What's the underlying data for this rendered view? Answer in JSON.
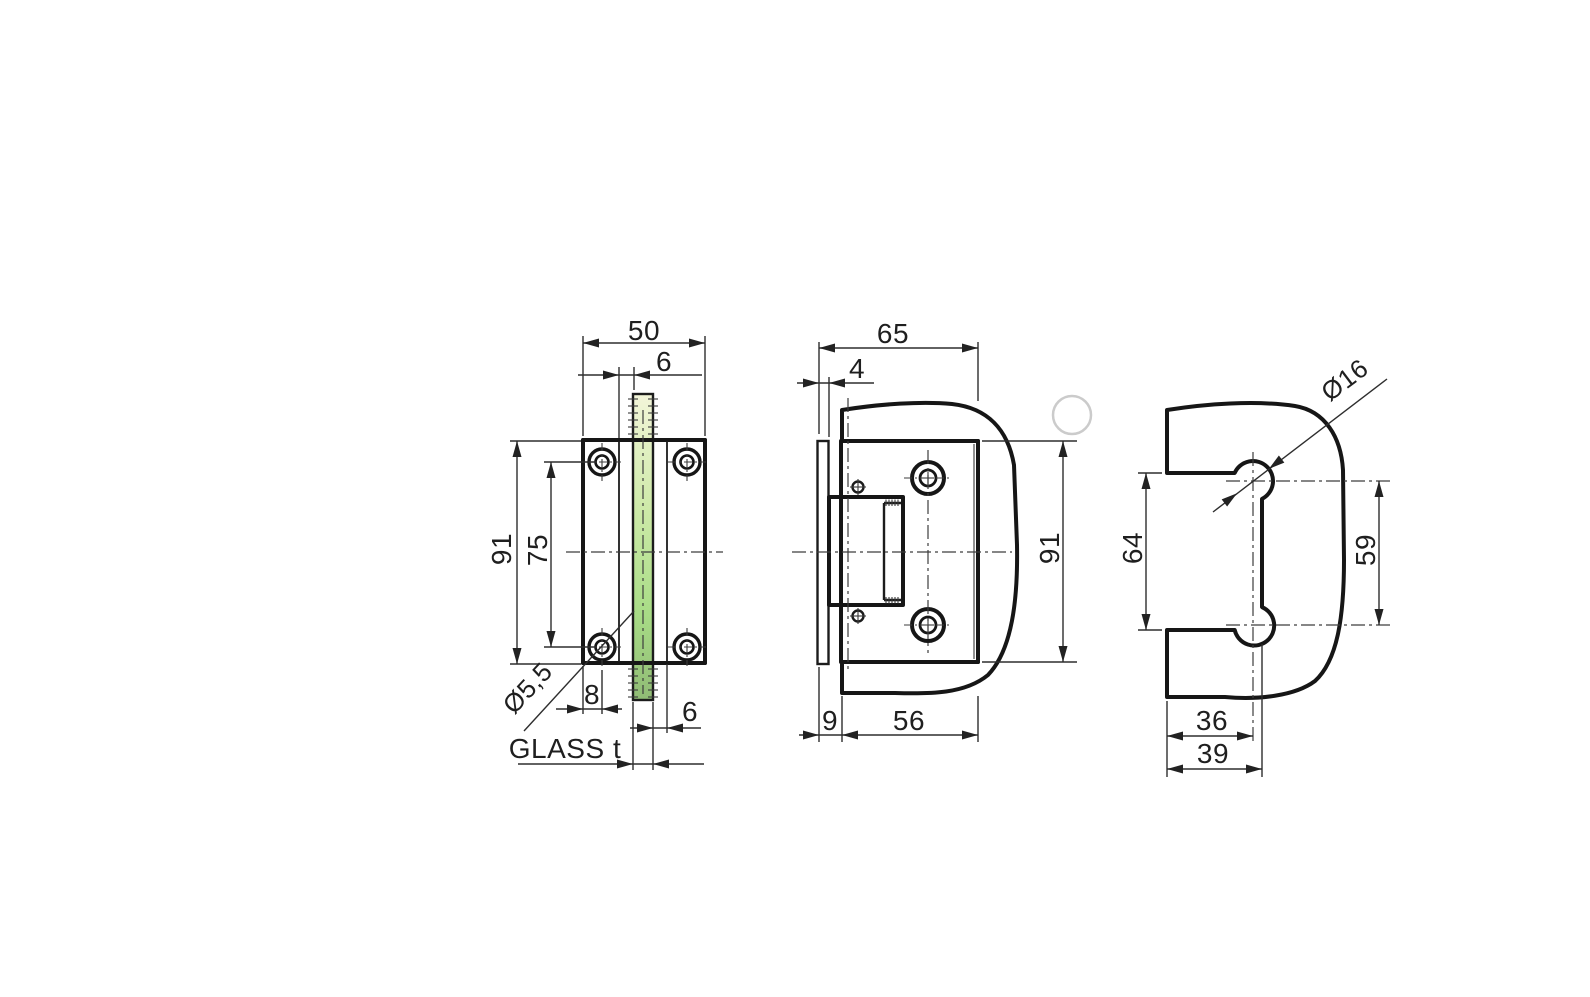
{
  "colors": {
    "outline": "#161616",
    "dim_line": "#2e2e2e",
    "label_text": "#1f1f1f",
    "front_glass_top": "#f3f5d9",
    "front_glass_mid": "#cdeaa8",
    "front_glass_low": "#a8dc86",
    "front_glass_bottom": "#90bb75",
    "side_glass_light": "#d8f3bd",
    "side_glass_dark": "#b5e494",
    "cutout_glass_light": "#cdefb3",
    "cutout_glass_dark": "#b2e294",
    "artifact_circle": "#cbcbcb"
  },
  "front_view": {
    "width": "50",
    "gap_top": "6",
    "height": "91",
    "hole_spacing": "75",
    "hole_diameter": "Ø5,5",
    "edge_to_hole": "8",
    "gap_bottom": "6",
    "glass_thickness": "GLASS t"
  },
  "side_view": {
    "width": "65",
    "wall_plate_thickness": "4",
    "height": "91",
    "glass_offset": "9",
    "cutout_width": "56"
  },
  "glass_cutout_view": {
    "hole_diameter": "Ø16",
    "opening_height": "64",
    "hole_spacing": "59",
    "hole_center_from_edge": "36",
    "opening_depth": "39"
  }
}
